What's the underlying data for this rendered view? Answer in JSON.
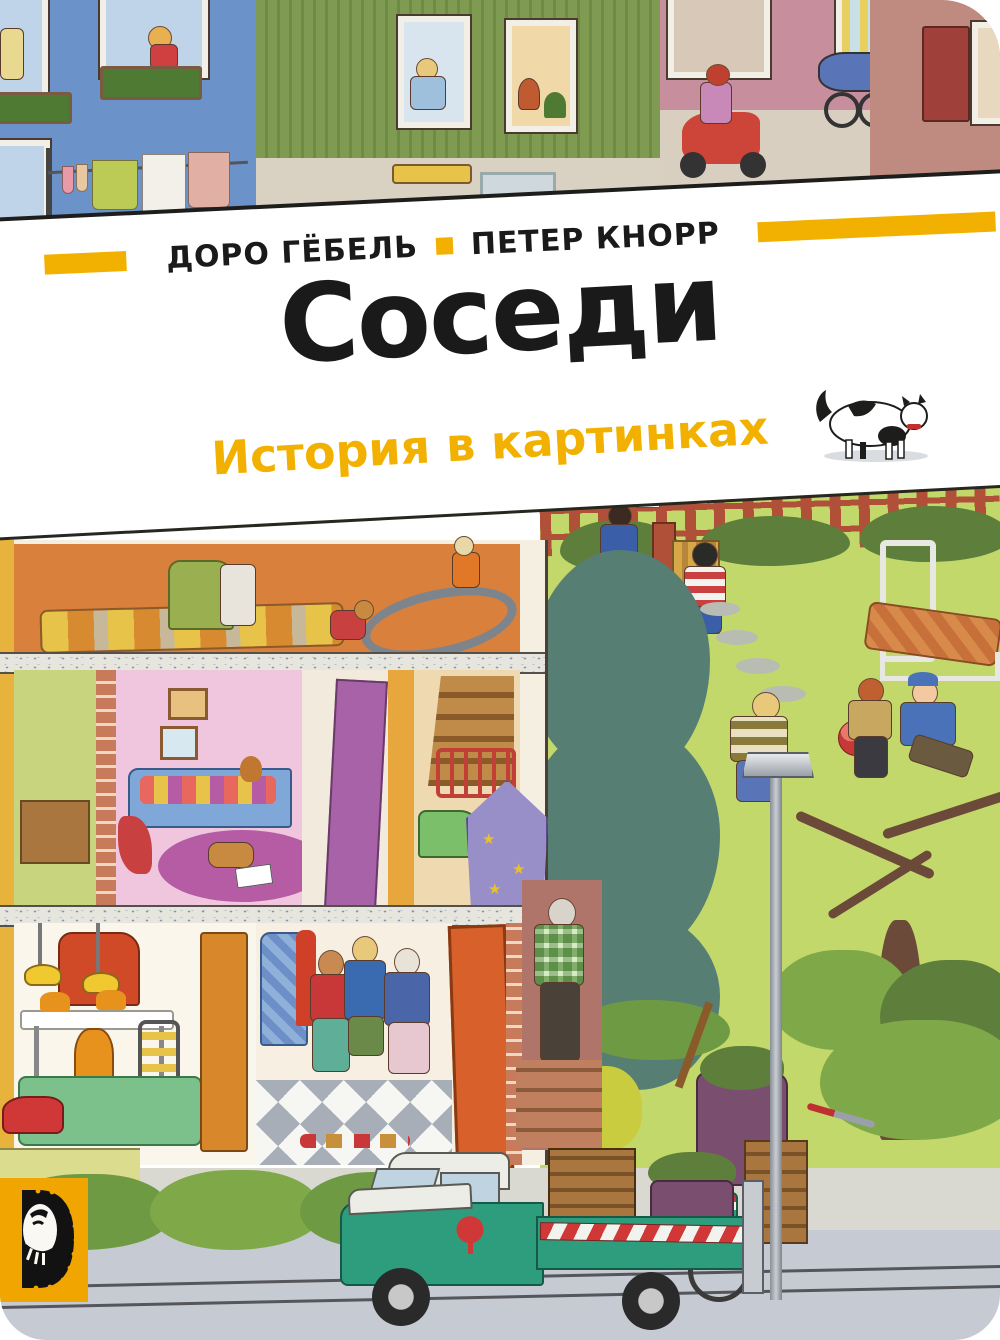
{
  "cover": {
    "authors": {
      "left": "ДОРО ГЁБЕЛЬ",
      "right": "ПЕТЕР КНОРР"
    },
    "title": "Соседи",
    "subtitle": "История в картинках"
  },
  "colors": {
    "accent": "#F2B100",
    "ink": "#1A1A1A",
    "blue_house": "#6B93C9",
    "green_house": "#7E9B51",
    "shop_pink": "#C78F9E",
    "mauve": "#BF8B80",
    "attic": "#D9813C",
    "pink_room": "#EFC6DE",
    "purple_rug": "#B55CA5",
    "lawn": "#C3D86A",
    "hedge": "#5E7F3C",
    "fence": "#B05038",
    "tree": "#567E72",
    "truck": "#2E9D7D",
    "door": "#D8602A",
    "logo_yellow": "#F0A500"
  }
}
